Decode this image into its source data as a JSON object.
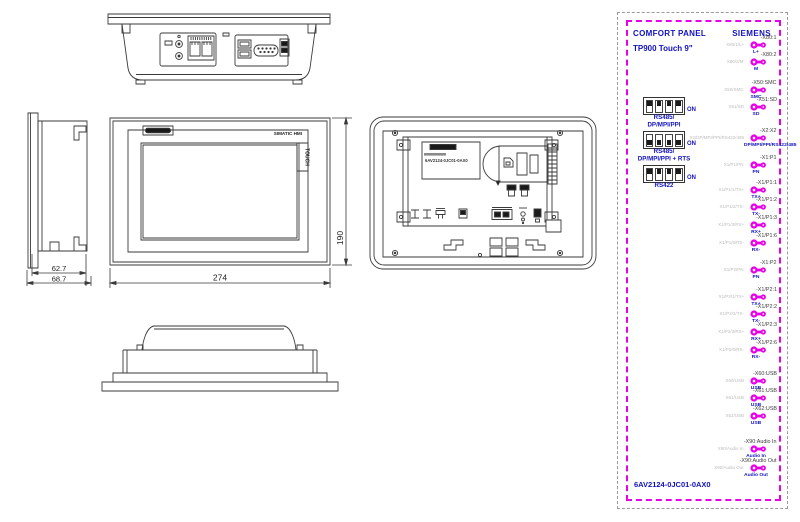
{
  "colors": {
    "blue": "#1212bd",
    "magenta": "#e800e8",
    "gray_ref": "#bcbcbc",
    "line": "#3a3a3a"
  },
  "drawing": {
    "front_view": {
      "brand_text": "SIMATIC HMI",
      "touch_label": "TOUCH",
      "width_dim": "274",
      "height_dim": "190"
    },
    "side_view": {
      "depth_body": "62.7",
      "depth_total": "68.7"
    },
    "back_view": {
      "model": "6AV2124-0JC01-0AX0"
    }
  },
  "panel": {
    "title": "COMFORT PANEL",
    "subtitle": "TP900 Touch 9\"",
    "brand": "SIEMENS",
    "order_number": "6AV2124-0JC01-0AX0",
    "dip_blocks": [
      {
        "line1": "RS485/",
        "line2": "DP/MPI/PPI",
        "on": "ON",
        "lever": "up"
      },
      {
        "line1": "RS485/",
        "line2": "DP/MPI/PPI + RTS",
        "on": "ON",
        "lever": "down"
      },
      {
        "line1": "RS422",
        "line2": "",
        "on": "ON",
        "lever": "up"
      }
    ],
    "connector_groups": [
      [
        {
          "ref": "X80/1/L+",
          "tag": "-X80:1",
          "signal": "L+"
        },
        {
          "ref": "X80/2/M",
          "tag": "-X80:2",
          "signal": "M"
        }
      ],
      [
        {
          "ref": "X50/SMC",
          "tag": "-X50:SMC",
          "signal": "SMC"
        },
        {
          "ref": "X51/SD",
          "tag": "-X51:SD",
          "signal": "SD"
        }
      ],
      [
        {
          "ref": "X2/DP/MPI/PPI/RS422/485",
          "tag": "-X2:X2",
          "signal": "DP/MPI/PPI/RS422/485"
        }
      ],
      [
        {
          "ref": "X1/P1/PN",
          "tag": "-X1:P1",
          "signal": "PN"
        }
      ],
      [
        {
          "ref": "X1/P1/1/TX+",
          "tag": "-X1/P1:1",
          "signal": "TX+"
        },
        {
          "ref": "X1/P1/2/TX-",
          "tag": "-X1/P1:2",
          "signal": "TX-"
        },
        {
          "ref": "X1/P1/3/RX+",
          "tag": "-X1/P1:3",
          "signal": "RX+"
        },
        {
          "ref": "X1/P1/6/RX-",
          "tag": "-X1/P1:6",
          "signal": "RX-"
        }
      ],
      [
        {
          "ref": "X1/P2/PN",
          "tag": "-X1:P2",
          "signal": "PN"
        }
      ],
      [
        {
          "ref": "X1/P2/1/TX+",
          "tag": "-X1/P2:1",
          "signal": "TX+"
        },
        {
          "ref": "X1/P2/2/TX-",
          "tag": "-X1/P2:2",
          "signal": "TX-"
        },
        {
          "ref": "X1/P2/3/RX+",
          "tag": "-X1/P2:3",
          "signal": "RX+"
        },
        {
          "ref": "X1/P2/6/RX-",
          "tag": "-X1/P2:6",
          "signal": "RX-"
        }
      ],
      [
        {
          "ref": "X60/USB",
          "tag": "-X60:USB",
          "signal": "USB"
        },
        {
          "ref": "X61/USB",
          "tag": "-X61:USB",
          "signal": "USB"
        },
        {
          "ref": "X62/USB",
          "tag": "-X62:USB",
          "signal": "USB"
        }
      ],
      [
        {
          "ref": "X90/Audio In",
          "tag": "-X90:Audio In",
          "signal": "Audio In"
        },
        {
          "ref": "X90/Audio Out",
          "tag": "-X90:Audio Out",
          "signal": "Audio Out"
        }
      ]
    ]
  }
}
